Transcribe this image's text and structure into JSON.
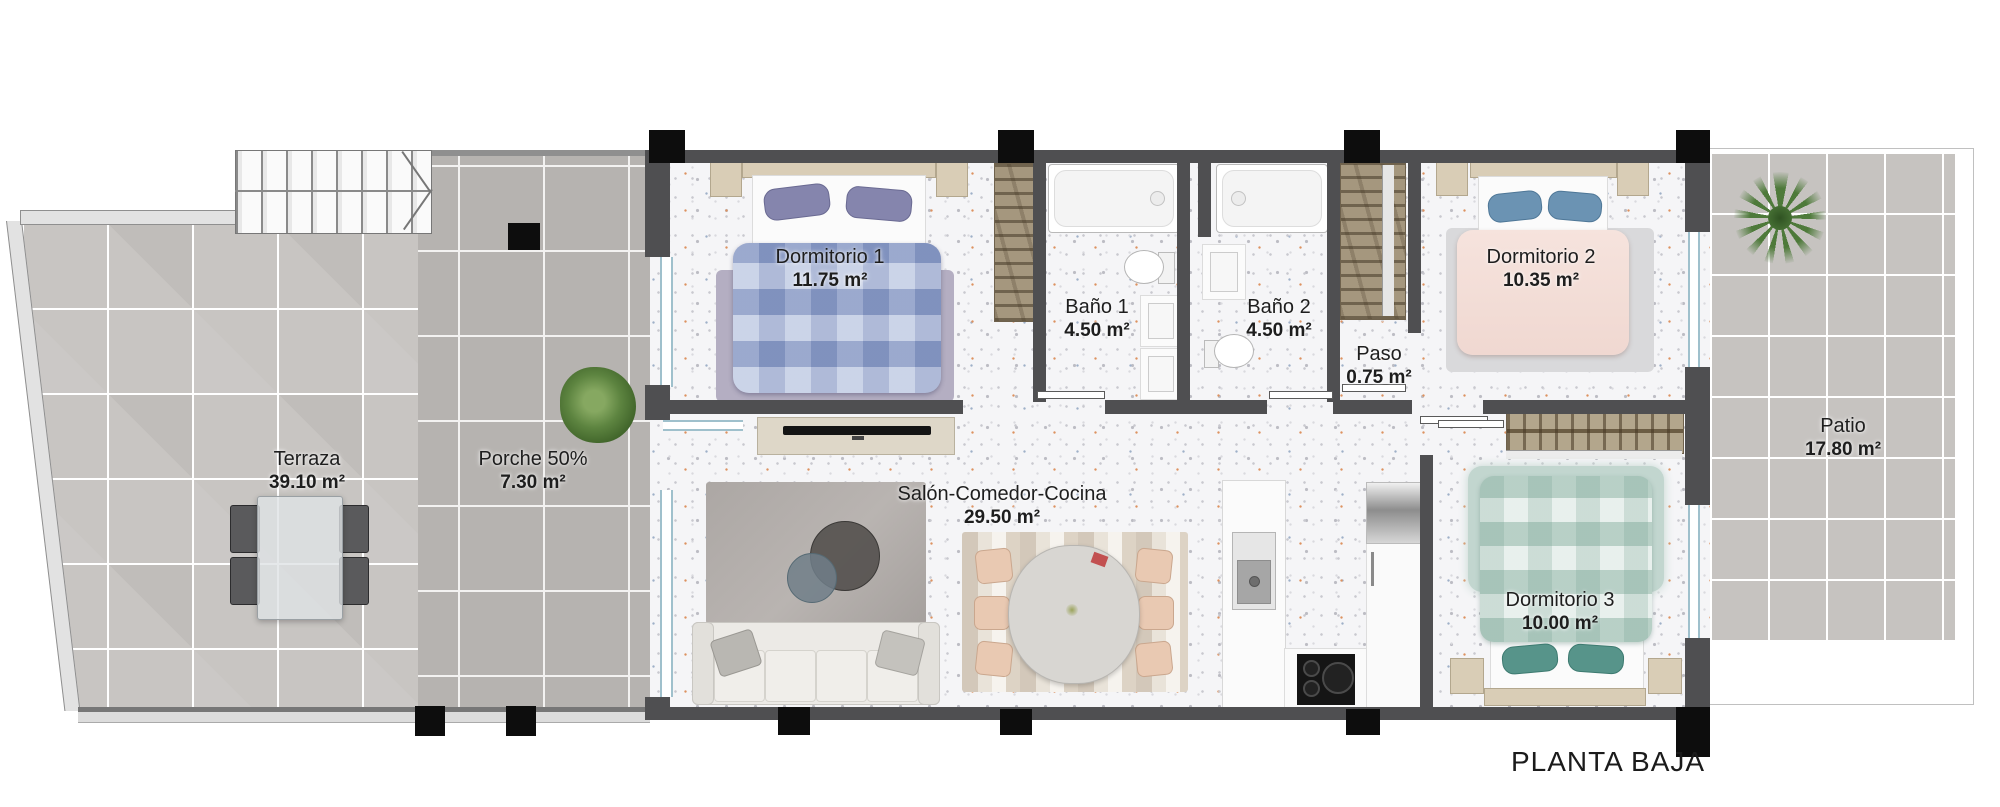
{
  "plan": {
    "title": "PLANTA BAJA"
  },
  "rooms": {
    "terraza": {
      "name": "Terraza",
      "area": "39.10 m²"
    },
    "porche": {
      "name": "Porche 50%",
      "area": "7.30 m²"
    },
    "dormitorio1": {
      "name": "Dormitorio 1",
      "area": "11.75 m²"
    },
    "bano1": {
      "name": "Baño 1",
      "area": "4.50 m²"
    },
    "bano2": {
      "name": "Baño 2",
      "area": "4.50 m²"
    },
    "paso": {
      "name": "Paso",
      "area": "0.75 m²"
    },
    "dormitorio2": {
      "name": "Dormitorio 2",
      "area": "10.35 m²"
    },
    "salon": {
      "name": "Salón-Comedor-Cocina",
      "area": "29.50 m²"
    },
    "dormitorio3": {
      "name": "Dormitorio 3",
      "area": "10.00 m²"
    },
    "patio": {
      "name": "Patio",
      "area": "17.80 m²"
    }
  },
  "colors": {
    "wall": "#4f4f51",
    "pillar": "#0d0d0d",
    "terraza_tile": "#c8c5c2",
    "porche_tile": "#b6b3b0",
    "patio_tile": "#c6c3c0",
    "window_glazing": "#9fc0cc",
    "wardrobe": "#a5977e",
    "bed1_plaid": "#a3b2d6",
    "bed2_linen": "#f3ded8",
    "bed3_plaid": "#d9e6e1",
    "plant_green": "#4e7a3a",
    "label_text": "#1e1e1e"
  },
  "icons": {
    "stairs": "stairs-up-arrow",
    "palm": "palm-tree-top",
    "bush": "shrub-top",
    "sink": "kitchen-sink",
    "cooktop": "induction-hob",
    "fridge": "refrigerator"
  }
}
